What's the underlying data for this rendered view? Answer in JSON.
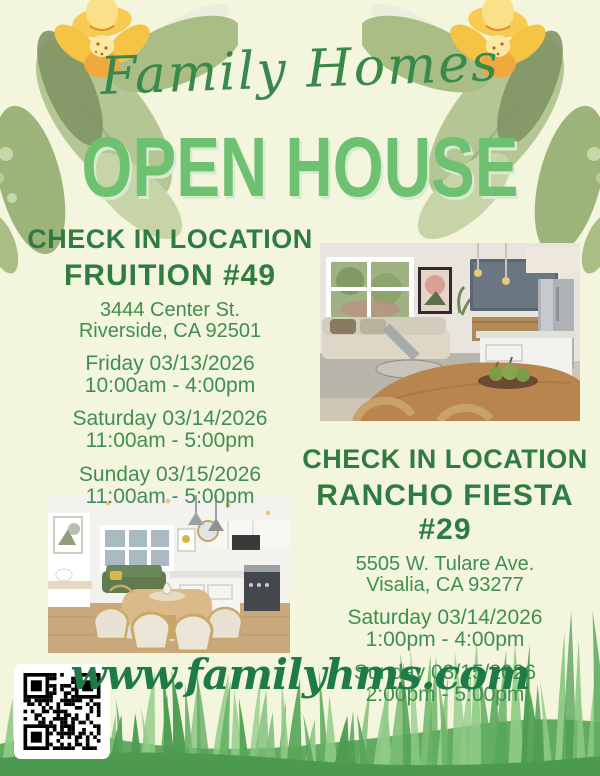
{
  "header": {
    "brand": "Family Homes",
    "title": "OPEN HOUSE"
  },
  "locations": [
    {
      "heading": "CHECK IN LOCATION",
      "name": "FRUITION #49",
      "address_line1": "3444 Center St.",
      "address_line2": "Riverside, CA 92501",
      "sessions": [
        {
          "day": "Friday 03/13/2026",
          "time": "10:00am - 4:00pm"
        },
        {
          "day": "Saturday 03/14/2026",
          "time": "11:00am - 5:00pm"
        },
        {
          "day": "Sunday 03/15/2026",
          "time": "11:00am - 5:00pm"
        }
      ]
    },
    {
      "heading": "CHECK IN LOCATION",
      "name": "RANCHO FIESTA #29",
      "address_line1": "5505 W. Tulare Ave.",
      "address_line2": "Visalia, CA 93277",
      "sessions": [
        {
          "day": "Saturday 03/14/2026",
          "time": "1:00pm - 4:00pm"
        },
        {
          "day": "Sunday 03/15/2026",
          "time": "2:00pm - 5:00pm"
        }
      ]
    }
  ],
  "footer": {
    "website": "www.familyhms.com"
  },
  "colors": {
    "background": "#f3f5dc",
    "title_green": "#6ec171",
    "heading_green": "#2e7c3f",
    "body_green": "#3f8f4f",
    "script_green": "#38894b",
    "website_green": "#1e7a47"
  }
}
